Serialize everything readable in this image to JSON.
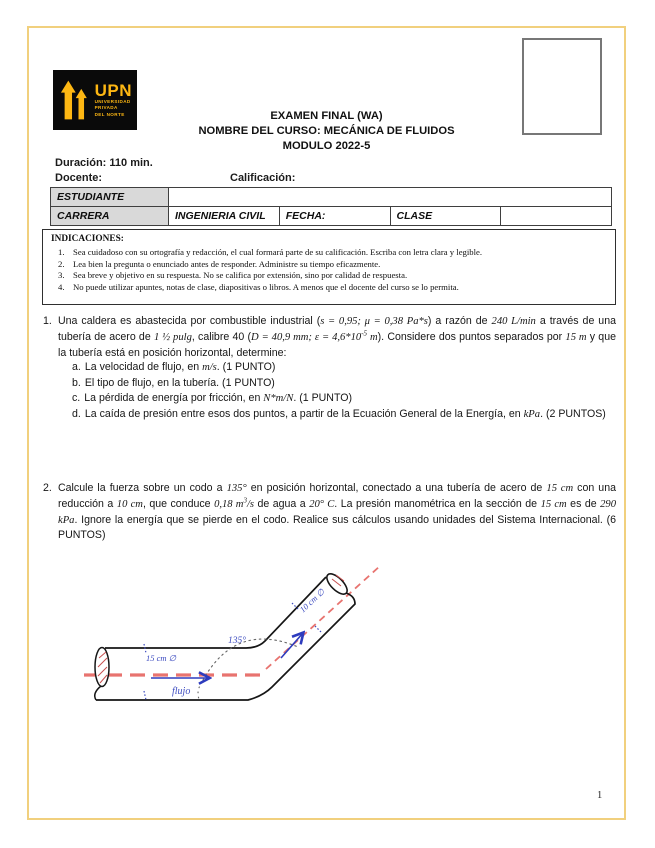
{
  "page": {
    "number": "1"
  },
  "colors": {
    "frame_gold": "#f1d07e",
    "logo_gold": "#fdb713",
    "centerline_red": "#e8736f",
    "annotation_blue": "#3d4cc0",
    "pipe_black": "#161616",
    "table_label_gray": "#d9d9d9"
  },
  "logo": {
    "brand": "UPN",
    "subtitle_lines": [
      "UNIVERSIDAD",
      "PRIVADA",
      "DEL NORTE"
    ]
  },
  "header": {
    "title_line1": "EXAMEN FINAL (WA)",
    "title_line2": "NOMBRE DEL CURSO: MECÁNICA DE FLUIDOS",
    "title_line3": "MODULO 2022-5",
    "duration_label": "Duración: 110 min.",
    "teacher_label": "Docente:",
    "grade_label": "Calificación:"
  },
  "info_table": {
    "student_label": "ESTUDIANTE",
    "student_value": "",
    "career_label": "CARRERA",
    "career_value": "INGENIERIA CIVIL",
    "date_label": "FECHA:",
    "class_label": "CLASE",
    "class_value": ""
  },
  "instructions": {
    "title": "INDICACIONES:",
    "items": [
      {
        "n": "1.",
        "text": "Sea cuidadoso con su ortografía y redacción, el cual formará parte de su calificación. Escriba con letra clara y legible."
      },
      {
        "n": "2.",
        "text": "Lea bien la pregunta o enunciado antes de responder. Administre su tiempo eficazmente."
      },
      {
        "n": "3.",
        "text": "Sea breve y objetivo en su respuesta. No se califica por extensión, sino por calidad de respuesta."
      },
      {
        "n": "4.",
        "text": "No puede utilizar apuntes, notas de clase, diapositivas o libros. A menos que el docente del curso se lo permita."
      }
    ]
  },
  "questions": [
    {
      "number": "1.",
      "body": [
        {
          "t": "Una caldera es abastecida por combustible industrial ("
        },
        {
          "t": "s = 0,95; μ = 0,38 Pa*s",
          "m": true
        },
        {
          "t": ") a razón de "
        },
        {
          "t": "240 L/min",
          "m": true
        },
        {
          "t": " a través de una tubería de acero de "
        },
        {
          "t": "1 ½ pulg",
          "m": true
        },
        {
          "t": ", calibre 40 ("
        },
        {
          "t": "D = 40,9 mm; ε = 4,6*10",
          "m": true
        },
        {
          "t": "-5",
          "m": true,
          "sup": true
        },
        {
          "t": " m",
          "m": true
        },
        {
          "t": "). Considere dos puntos separados por "
        },
        {
          "t": "15 m",
          "m": true
        },
        {
          "t": " y que la tubería está en posición horizontal, determine:"
        }
      ],
      "subitems": [
        {
          "label": "a.",
          "segments": [
            {
              "t": "La velocidad de flujo, en "
            },
            {
              "t": "m/s",
              "m": true
            },
            {
              "t": ". (1 PUNTO)"
            }
          ]
        },
        {
          "label": "b.",
          "segments": [
            {
              "t": "El tipo de flujo, en la tubería. (1 PUNTO)"
            }
          ]
        },
        {
          "label": "c.",
          "segments": [
            {
              "t": "La pérdida de energía por fricción, en "
            },
            {
              "t": "N*m/N",
              "m": true
            },
            {
              "t": ". (1 PUNTO)"
            }
          ]
        },
        {
          "label": "d.",
          "segments": [
            {
              "t": "La caída de presión entre esos dos puntos, a partir de la Ecuación General de la Energía, en "
            },
            {
              "t": "kPa",
              "m": true
            },
            {
              "t": ". (2 PUNTOS)"
            }
          ]
        }
      ]
    },
    {
      "number": "2.",
      "body": [
        {
          "t": "Calcule la fuerza sobre un codo a "
        },
        {
          "t": "135°",
          "m": true
        },
        {
          "t": " en posición horizontal, conectado a una tubería de acero de "
        },
        {
          "t": "15 cm",
          "m": true
        },
        {
          "t": " con una reducción a "
        },
        {
          "t": "10 cm",
          "m": true
        },
        {
          "t": ", que conduce "
        },
        {
          "t": "0,18 m",
          "m": true
        },
        {
          "t": "3",
          "m": true,
          "sup": true
        },
        {
          "t": "/s",
          "m": true
        },
        {
          "t": " de agua a "
        },
        {
          "t": "20° C",
          "m": true
        },
        {
          "t": ". La presión manométrica en la sección de "
        },
        {
          "t": "15 cm",
          "m": true
        },
        {
          "t": " es de "
        },
        {
          "t": "290 kPa",
          "m": true
        },
        {
          "t": ". Ignore la energía que se pierde en el codo. Realice sus cálculos usando unidades del Sistema Internacional. (6 PUNTOS)"
        }
      ],
      "subitems": []
    }
  ],
  "diagram": {
    "labels": {
      "angle": "135°",
      "inlet_diameter": "15 cm ∅",
      "flow": "flujo",
      "outlet_diameter": "10 cm ∅"
    }
  }
}
